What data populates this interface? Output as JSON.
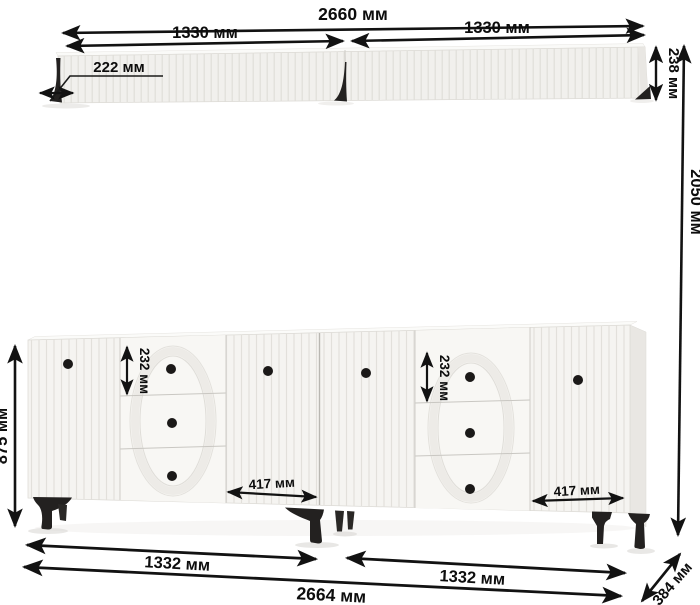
{
  "diagram": {
    "unit": "мм",
    "shelf": {
      "total_width": "2660 мм",
      "section_left": "1330 мм",
      "section_right": "1330 мм",
      "depth": "222 мм",
      "height": "238 мм"
    },
    "wall_height": "2050 мм",
    "sideboard": {
      "height": "875 мм",
      "drawer_height_left": "232 мм",
      "drawer_height_right": "232 мм",
      "door_width_left": "417 мм",
      "door_width_right": "417 мм",
      "section_left": "1332 мм",
      "section_right": "1332 мм",
      "total_width": "2664 мм",
      "depth": "384 мм"
    }
  }
}
